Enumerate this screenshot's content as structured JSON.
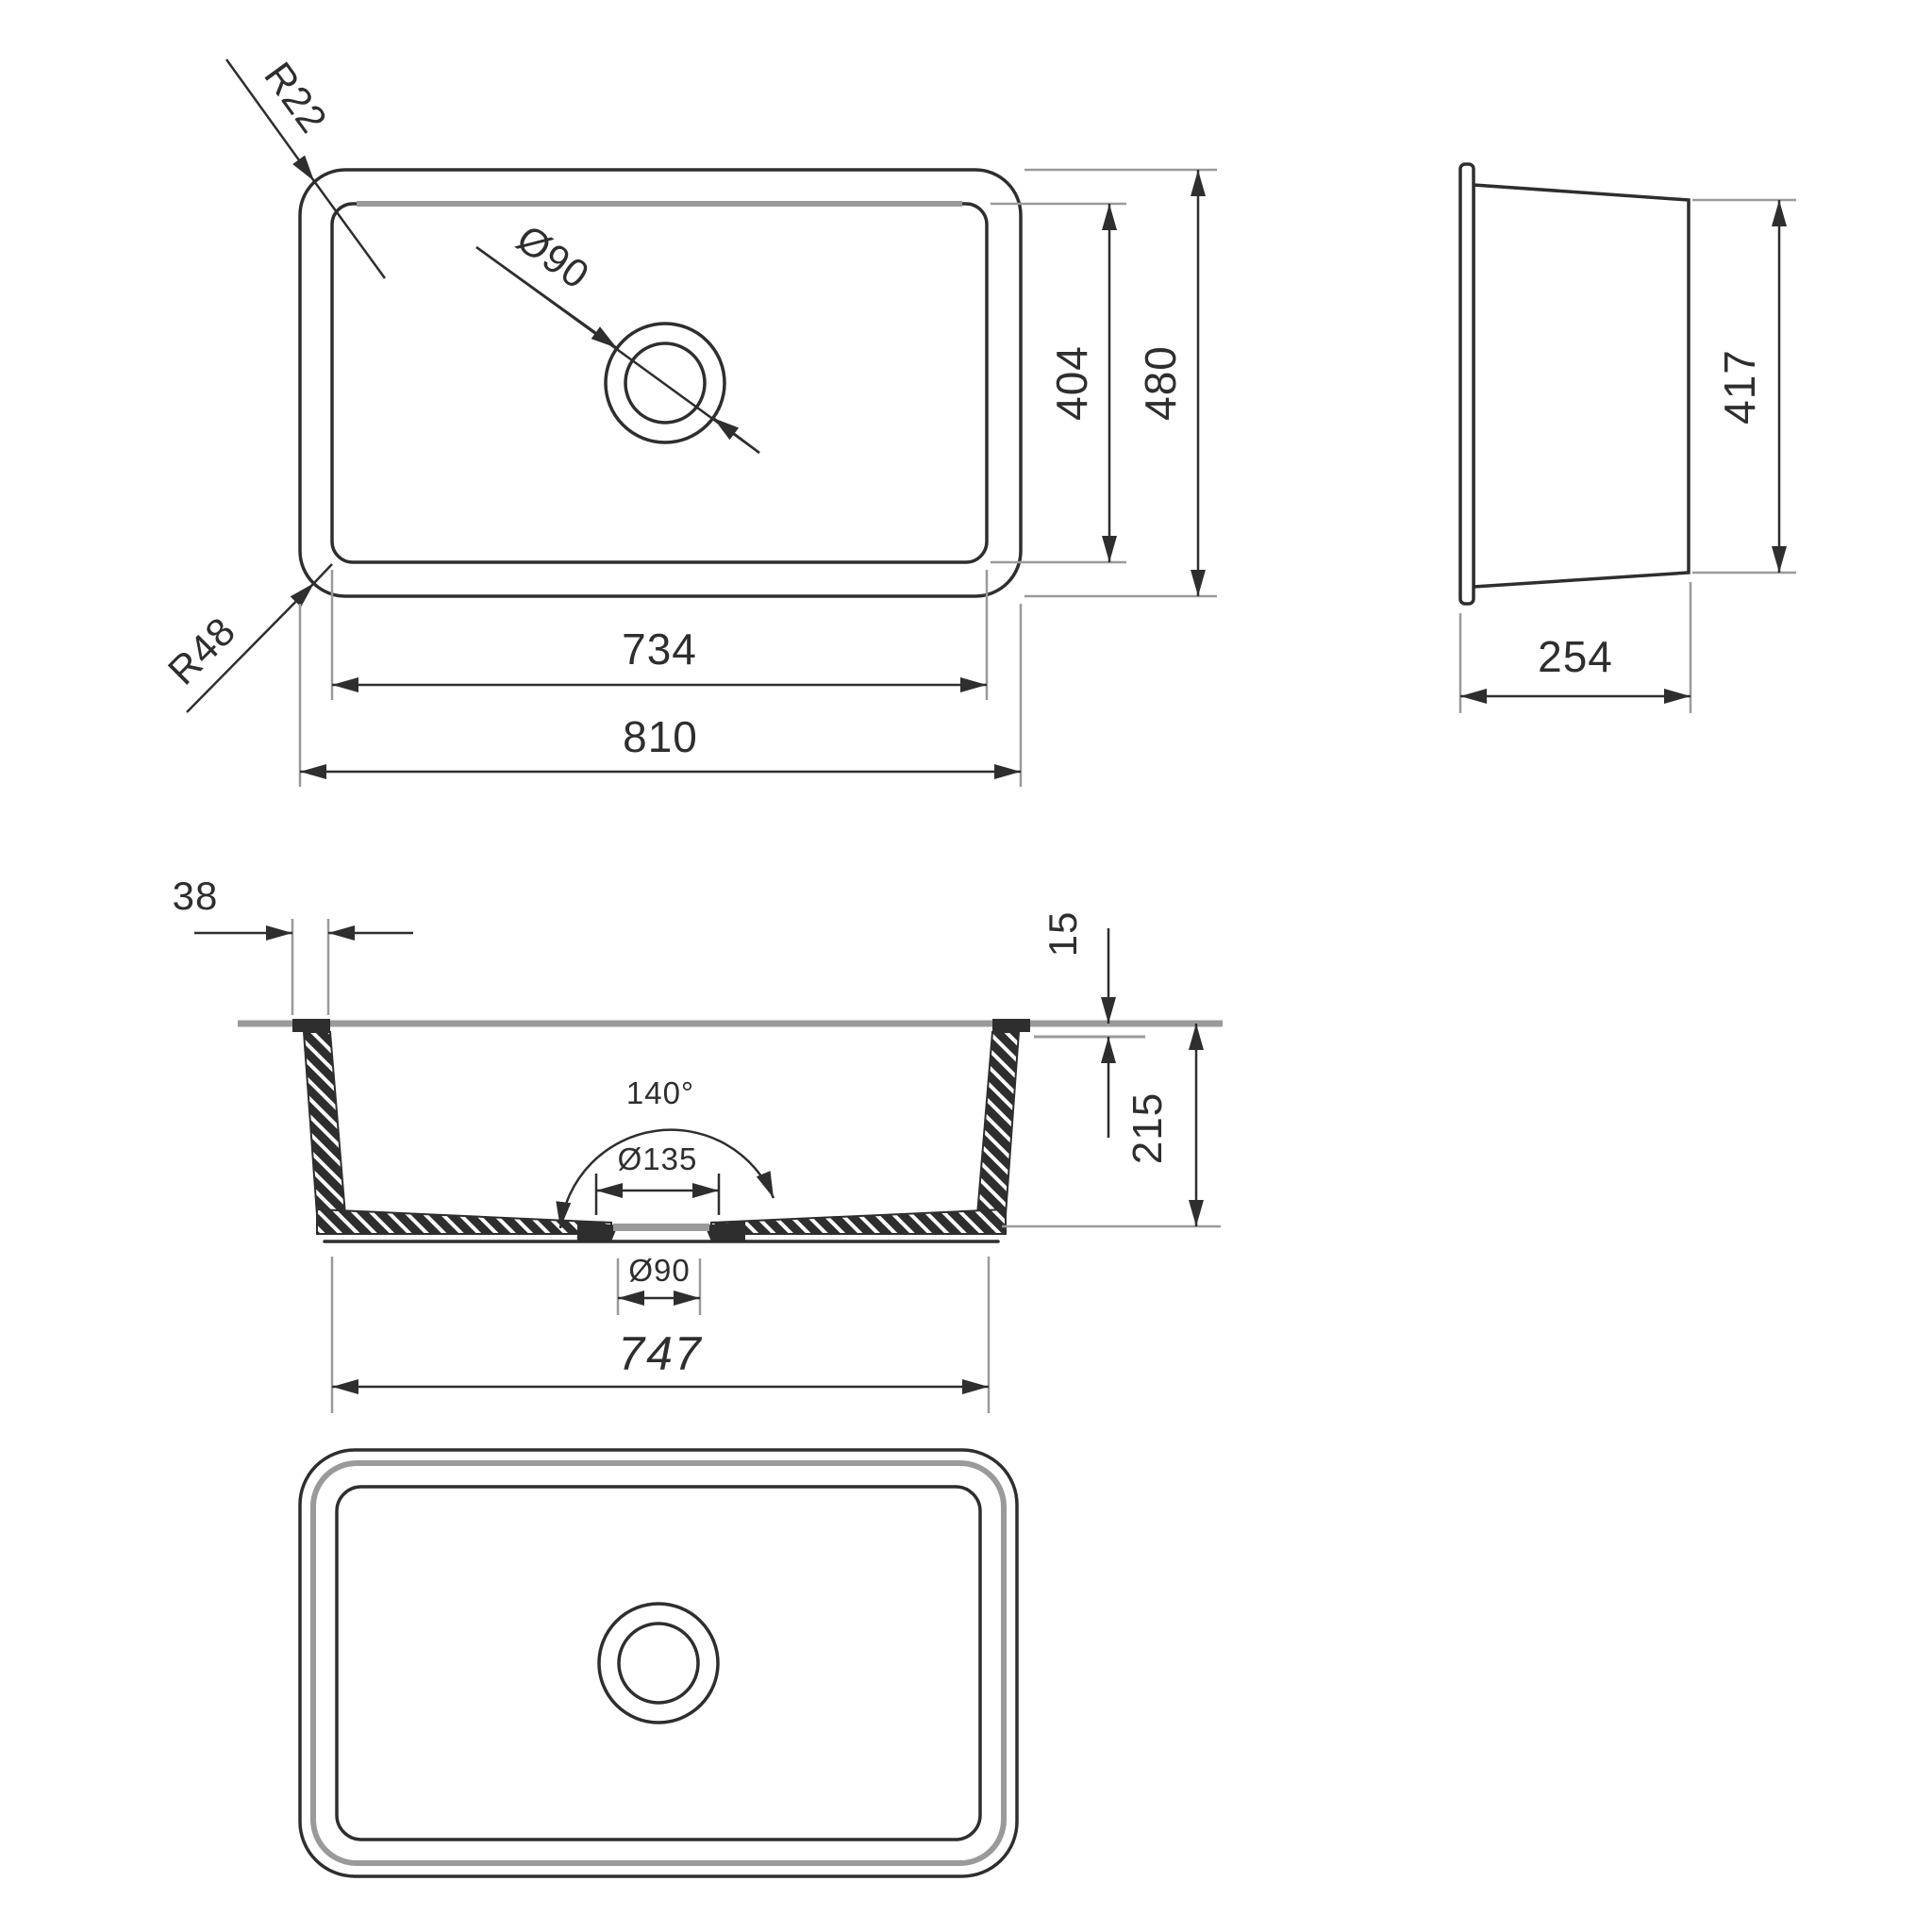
{
  "colors": {
    "line": "#2e2e2e",
    "secondary_gray": "#9a9a9a",
    "background": "#ffffff"
  },
  "top_view": {
    "corner_radius_inner": "R22",
    "corner_radius_outer": "R48",
    "drain_diameter": "Ø90",
    "inner_length": "734",
    "overall_length": "810",
    "inner_width": "404",
    "overall_width": "480"
  },
  "side_view": {
    "bottom_length": "417",
    "end_width": "254"
  },
  "section_view": {
    "rim_wall_offset": "38",
    "rim_thickness": "15",
    "bowl_depth": "215",
    "drain_cone_angle": "140°",
    "drain_recess_diameter": "Ø135",
    "drain_hole_diameter": "Ø90",
    "base_length": "747"
  }
}
